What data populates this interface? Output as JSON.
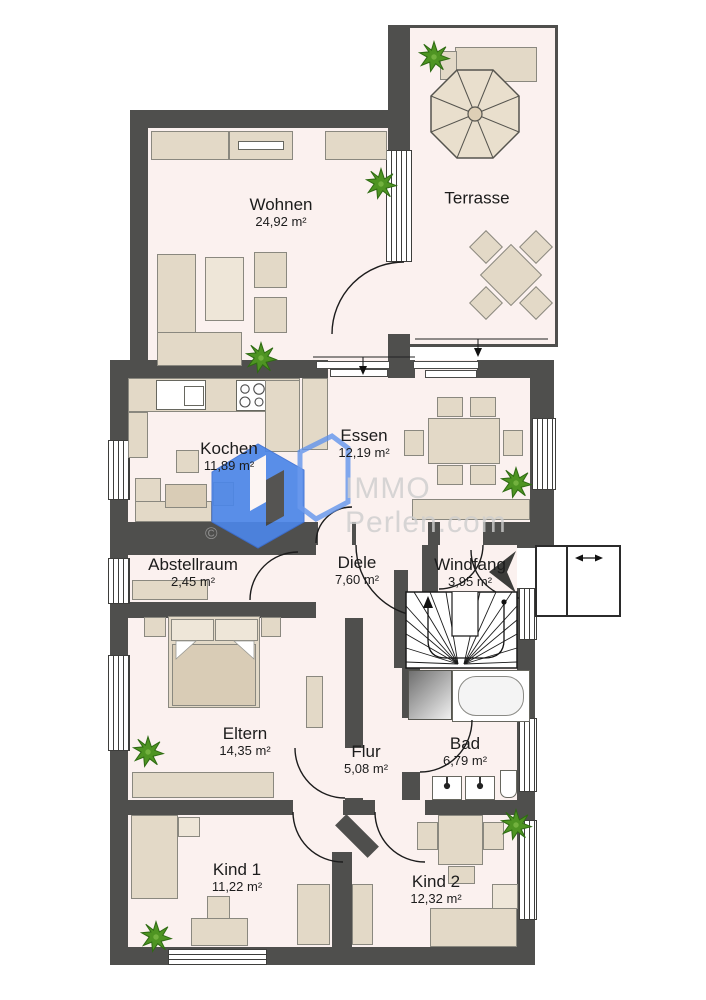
{
  "plan": {
    "width": 706,
    "height": 1000,
    "type": "apartment-floorplan"
  },
  "rooms": {
    "wohnen": {
      "name": "Wohnen",
      "area": "24,92 m²"
    },
    "terrasse": {
      "name": "Terrasse",
      "area": ""
    },
    "kochen": {
      "name": "Kochen",
      "area": "11,89 m²"
    },
    "essen": {
      "name": "Essen",
      "area": "12,19 m²"
    },
    "abstellraum": {
      "name": "Abstellraum",
      "area": "2,45 m²"
    },
    "diele": {
      "name": "Diele",
      "area": "7,60 m²"
    },
    "windfang": {
      "name": "Windfang",
      "area": "3,95 m²"
    },
    "eltern": {
      "name": "Eltern",
      "area": "14,35 m²"
    },
    "flur": {
      "name": "Flur",
      "area": "5,08 m²"
    },
    "bad": {
      "name": "Bad",
      "area": "6,79 m²"
    },
    "kind1": {
      "name": "Kind 1",
      "area": "11,22 m²"
    },
    "kind2": {
      "name": "Kind 2",
      "area": "12,32 m²"
    }
  },
  "watermark": {
    "brand_top": "IMMO",
    "brand_bottom": "Perlen.com",
    "copyright": "©"
  },
  "colors": {
    "wall": "#4f4f4d",
    "floor": "#fbf1ef",
    "furniture": "#e3d9c7",
    "furniture_dark": "#d9ccb6",
    "plant_green": "#4e9422",
    "watermark_blue": "#4c86e8",
    "watermark_text": "#cfcfcf"
  }
}
